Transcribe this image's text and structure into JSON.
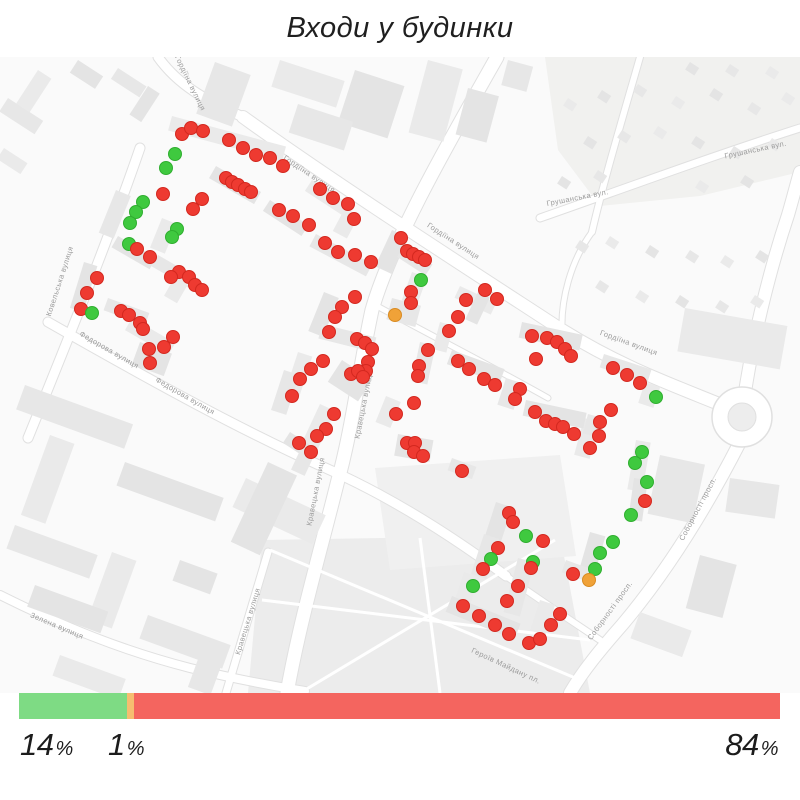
{
  "title": "Входи у будинки",
  "colors": {
    "marker": {
      "r": "#ee3a31",
      "g": "#3fc93f",
      "o": "#f0a238"
    },
    "marker_stroke": {
      "r": "#d3281f",
      "g": "#2fae2f",
      "o": "#d98b22"
    },
    "bar": {
      "green": "#7edb84",
      "orange": "#f6bd70",
      "red": "#f4655f"
    },
    "map_background": "#fafafa",
    "street_label": "#9b9b9b"
  },
  "legend": {
    "green": {
      "value": "14",
      "suffix": "%"
    },
    "orange": {
      "value": "1",
      "suffix": "%"
    },
    "red": {
      "value": "84",
      "suffix": "%"
    }
  },
  "chart_data": {
    "type": "bar",
    "title": "Входи у будинки",
    "orientation": "horizontal-stacked",
    "categories": [
      "green",
      "orange",
      "red"
    ],
    "values": [
      14,
      1,
      84
    ],
    "unit": "%",
    "colors": [
      "#7edb84",
      "#f6bd70",
      "#f4655f"
    ],
    "labels": [
      "14%",
      "1%",
      "84%"
    ]
  },
  "map": {
    "street_labels": [
      {
        "text": "Гордіїна вулиця",
        "x": 188,
        "y": 84,
        "rot": 64
      },
      {
        "text": "Гордіїна вулиця",
        "x": 308,
        "y": 176,
        "rot": 34
      },
      {
        "text": "Гордіїна вулиця",
        "x": 452,
        "y": 243,
        "rot": 33
      },
      {
        "text": "Гордіїна вулиця",
        "x": 628,
        "y": 345,
        "rot": 20
      },
      {
        "text": "Грушанська вул.",
        "x": 578,
        "y": 200,
        "rot": -11
      },
      {
        "text": "Грушанська вул.",
        "x": 756,
        "y": 152,
        "rot": -12
      },
      {
        "text": "Ковельська вулиця",
        "x": 62,
        "y": 282,
        "rot": -72
      },
      {
        "text": "Федорова вулиця",
        "x": 108,
        "y": 352,
        "rot": 30
      },
      {
        "text": "Федорова вулиця",
        "x": 184,
        "y": 398,
        "rot": 30
      },
      {
        "text": "Кравецька вулиця",
        "x": 366,
        "y": 405,
        "rot": -79
      },
      {
        "text": "Кравецька вулиця",
        "x": 318,
        "y": 492,
        "rot": -79
      },
      {
        "text": "Кравецька вулиця",
        "x": 250,
        "y": 622,
        "rot": -73
      },
      {
        "text": "Зелена вулиця",
        "x": 56,
        "y": 628,
        "rot": 23
      },
      {
        "text": "Соборності просп.",
        "x": 700,
        "y": 510,
        "rot": -62
      },
      {
        "text": "Соборності просп.",
        "x": 612,
        "y": 612,
        "rot": -54
      },
      {
        "text": "Героїв Майдану пл.",
        "x": 505,
        "y": 668,
        "rot": 25
      }
    ],
    "markers": [
      [
        182,
        134,
        "r"
      ],
      [
        191,
        128,
        "r"
      ],
      [
        203,
        131,
        "r"
      ],
      [
        229,
        140,
        "r"
      ],
      [
        243,
        148,
        "r"
      ],
      [
        256,
        155,
        "r"
      ],
      [
        270,
        158,
        "r"
      ],
      [
        283,
        166,
        "r"
      ],
      [
        175,
        154,
        "g"
      ],
      [
        166,
        168,
        "g"
      ],
      [
        226,
        178,
        "r"
      ],
      [
        232,
        182,
        "r"
      ],
      [
        238,
        185,
        "r"
      ],
      [
        245,
        189,
        "r"
      ],
      [
        251,
        192,
        "r"
      ],
      [
        163,
        194,
        "r"
      ],
      [
        202,
        199,
        "r"
      ],
      [
        193,
        209,
        "r"
      ],
      [
        143,
        202,
        "g"
      ],
      [
        136,
        212,
        "g"
      ],
      [
        130,
        223,
        "g"
      ],
      [
        177,
        229,
        "g"
      ],
      [
        172,
        237,
        "g"
      ],
      [
        129,
        244,
        "g"
      ],
      [
        137,
        249,
        "r"
      ],
      [
        150,
        257,
        "r"
      ],
      [
        179,
        272,
        "r"
      ],
      [
        171,
        277,
        "r"
      ],
      [
        189,
        277,
        "r"
      ],
      [
        195,
        285,
        "r"
      ],
      [
        202,
        290,
        "r"
      ],
      [
        97,
        278,
        "r"
      ],
      [
        87,
        293,
        "r"
      ],
      [
        81,
        309,
        "r"
      ],
      [
        92,
        313,
        "g"
      ],
      [
        121,
        311,
        "r"
      ],
      [
        129,
        315,
        "r"
      ],
      [
        140,
        323,
        "r"
      ],
      [
        143,
        329,
        "r"
      ],
      [
        173,
        337,
        "r"
      ],
      [
        164,
        347,
        "r"
      ],
      [
        149,
        349,
        "r"
      ],
      [
        150,
        363,
        "r"
      ],
      [
        320,
        189,
        "r"
      ],
      [
        333,
        198,
        "r"
      ],
      [
        348,
        204,
        "r"
      ],
      [
        279,
        210,
        "r"
      ],
      [
        293,
        216,
        "r"
      ],
      [
        309,
        225,
        "r"
      ],
      [
        354,
        219,
        "r"
      ],
      [
        325,
        243,
        "r"
      ],
      [
        338,
        252,
        "r"
      ],
      [
        355,
        255,
        "r"
      ],
      [
        371,
        262,
        "r"
      ],
      [
        401,
        238,
        "r"
      ],
      [
        407,
        251,
        "r"
      ],
      [
        413,
        254,
        "r"
      ],
      [
        419,
        257,
        "r"
      ],
      [
        425,
        260,
        "r"
      ],
      [
        421,
        280,
        "g"
      ],
      [
        411,
        292,
        "r"
      ],
      [
        355,
        297,
        "r"
      ],
      [
        342,
        307,
        "r"
      ],
      [
        335,
        317,
        "r"
      ],
      [
        411,
        303,
        "r"
      ],
      [
        395,
        315,
        "o"
      ],
      [
        485,
        290,
        "r"
      ],
      [
        466,
        300,
        "r"
      ],
      [
        497,
        299,
        "r"
      ],
      [
        458,
        317,
        "r"
      ],
      [
        329,
        332,
        "r"
      ],
      [
        357,
        339,
        "r"
      ],
      [
        365,
        343,
        "r"
      ],
      [
        372,
        349,
        "r"
      ],
      [
        323,
        361,
        "r"
      ],
      [
        311,
        369,
        "r"
      ],
      [
        368,
        362,
        "r"
      ],
      [
        366,
        371,
        "r"
      ],
      [
        351,
        374,
        "r"
      ],
      [
        358,
        371,
        "r"
      ],
      [
        363,
        377,
        "r"
      ],
      [
        300,
        379,
        "r"
      ],
      [
        292,
        396,
        "r"
      ],
      [
        334,
        414,
        "r"
      ],
      [
        326,
        429,
        "r"
      ],
      [
        317,
        436,
        "r"
      ],
      [
        299,
        443,
        "r"
      ],
      [
        311,
        452,
        "r"
      ],
      [
        428,
        350,
        "r"
      ],
      [
        419,
        366,
        "r"
      ],
      [
        418,
        376,
        "r"
      ],
      [
        449,
        331,
        "r"
      ],
      [
        458,
        361,
        "r"
      ],
      [
        469,
        369,
        "r"
      ],
      [
        484,
        379,
        "r"
      ],
      [
        495,
        385,
        "r"
      ],
      [
        520,
        389,
        "r"
      ],
      [
        515,
        399,
        "r"
      ],
      [
        414,
        403,
        "r"
      ],
      [
        396,
        414,
        "r"
      ],
      [
        407,
        443,
        "r"
      ],
      [
        415,
        443,
        "r"
      ],
      [
        414,
        452,
        "r"
      ],
      [
        423,
        456,
        "r"
      ],
      [
        462,
        471,
        "r"
      ],
      [
        532,
        336,
        "r"
      ],
      [
        547,
        338,
        "r"
      ],
      [
        557,
        342,
        "r"
      ],
      [
        565,
        349,
        "r"
      ],
      [
        571,
        356,
        "r"
      ],
      [
        536,
        359,
        "r"
      ],
      [
        613,
        368,
        "r"
      ],
      [
        627,
        375,
        "r"
      ],
      [
        640,
        383,
        "r"
      ],
      [
        656,
        397,
        "g"
      ],
      [
        611,
        410,
        "r"
      ],
      [
        535,
        412,
        "r"
      ],
      [
        546,
        421,
        "r"
      ],
      [
        555,
        424,
        "r"
      ],
      [
        563,
        427,
        "r"
      ],
      [
        574,
        434,
        "r"
      ],
      [
        600,
        422,
        "r"
      ],
      [
        599,
        436,
        "r"
      ],
      [
        590,
        448,
        "r"
      ],
      [
        642,
        452,
        "g"
      ],
      [
        635,
        463,
        "g"
      ],
      [
        647,
        482,
        "g"
      ],
      [
        645,
        501,
        "r"
      ],
      [
        631,
        515,
        "g"
      ],
      [
        509,
        513,
        "r"
      ],
      [
        513,
        522,
        "r"
      ],
      [
        526,
        536,
        "g"
      ],
      [
        543,
        541,
        "r"
      ],
      [
        498,
        548,
        "r"
      ],
      [
        491,
        559,
        "g"
      ],
      [
        483,
        569,
        "r"
      ],
      [
        473,
        586,
        "g"
      ],
      [
        463,
        606,
        "r"
      ],
      [
        479,
        616,
        "r"
      ],
      [
        495,
        625,
        "r"
      ],
      [
        509,
        634,
        "r"
      ],
      [
        529,
        643,
        "r"
      ],
      [
        540,
        639,
        "r"
      ],
      [
        560,
        614,
        "r"
      ],
      [
        551,
        625,
        "r"
      ],
      [
        533,
        562,
        "g"
      ],
      [
        531,
        568,
        "r"
      ],
      [
        518,
        586,
        "r"
      ],
      [
        507,
        601,
        "r"
      ],
      [
        613,
        542,
        "g"
      ],
      [
        600,
        553,
        "g"
      ],
      [
        595,
        569,
        "g"
      ],
      [
        573,
        574,
        "r"
      ],
      [
        589,
        580,
        "o"
      ]
    ]
  }
}
